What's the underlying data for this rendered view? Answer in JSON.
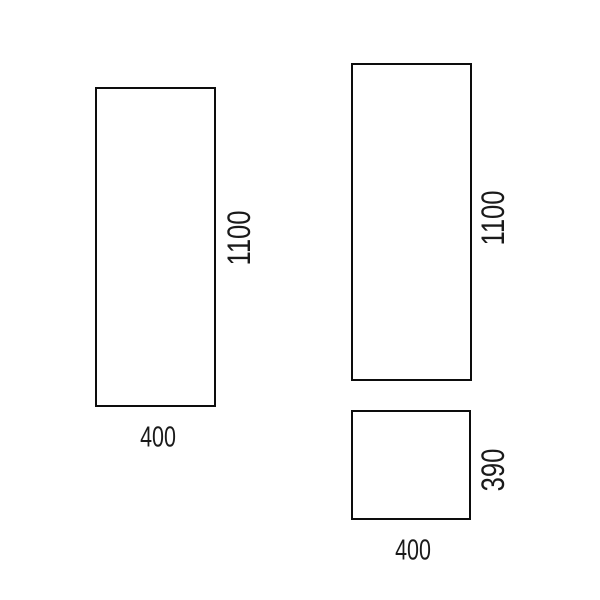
{
  "drawing": {
    "type": "technical-dimension-drawing",
    "colors": {
      "background": "#ffffff",
      "line": "#0d0d0d",
      "text": "#1a1a1a"
    },
    "panels": {
      "left": {
        "name": "left-panel",
        "height_label": "1100",
        "width_label": "400"
      },
      "right_tall": {
        "name": "right-tall-panel",
        "height_label": "1100"
      },
      "right_small": {
        "name": "right-small-panel",
        "height_label": "390",
        "width_label": "400"
      }
    }
  }
}
